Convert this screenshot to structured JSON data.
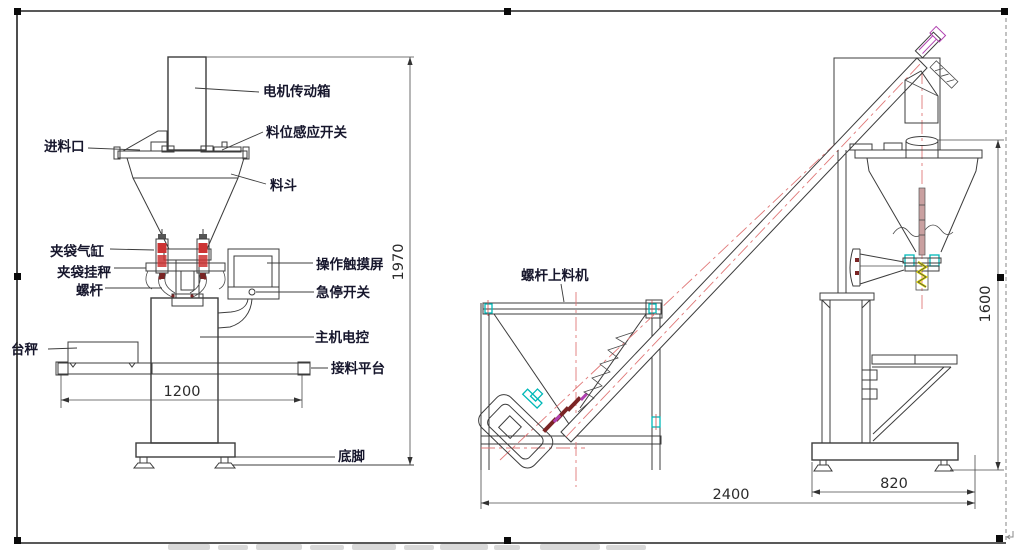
{
  "drawing": {
    "labels": {
      "motor_gearbox": "电机传动箱",
      "level_sensor": "料位感应开关",
      "feed_inlet": "进料口",
      "hopper": "料斗",
      "bag_clamp_cylinder": "夹袋气缸",
      "bag_clamp_scale": "夹袋挂秤",
      "screw": "螺杆",
      "touch_screen": "操作触摸屏",
      "emergency_stop": "急停开关",
      "main_electric_control": "主机电控",
      "receiving_platform": "接料平台",
      "platform_scale": "台秤",
      "foot": "底脚",
      "screw_feeder": "螺杆上料机"
    },
    "dimensions": {
      "main_width": "1200",
      "main_height": "1970",
      "feeder_height": "1600",
      "feeder_length": "2400",
      "feeder_base_width": "820"
    },
    "colors": {
      "line": "#3c3c3c",
      "centerline_red": "#e07878",
      "cylinder_red": "#cc3333",
      "accent_teal": "#00b8b8",
      "accent_yellow": "#e6df00",
      "accent_magenta": "#b040b0",
      "bolt_maroon": "#7a2424",
      "selection_handle": "#0a0a0a",
      "watermark_grey": "#d9d9d9"
    }
  }
}
